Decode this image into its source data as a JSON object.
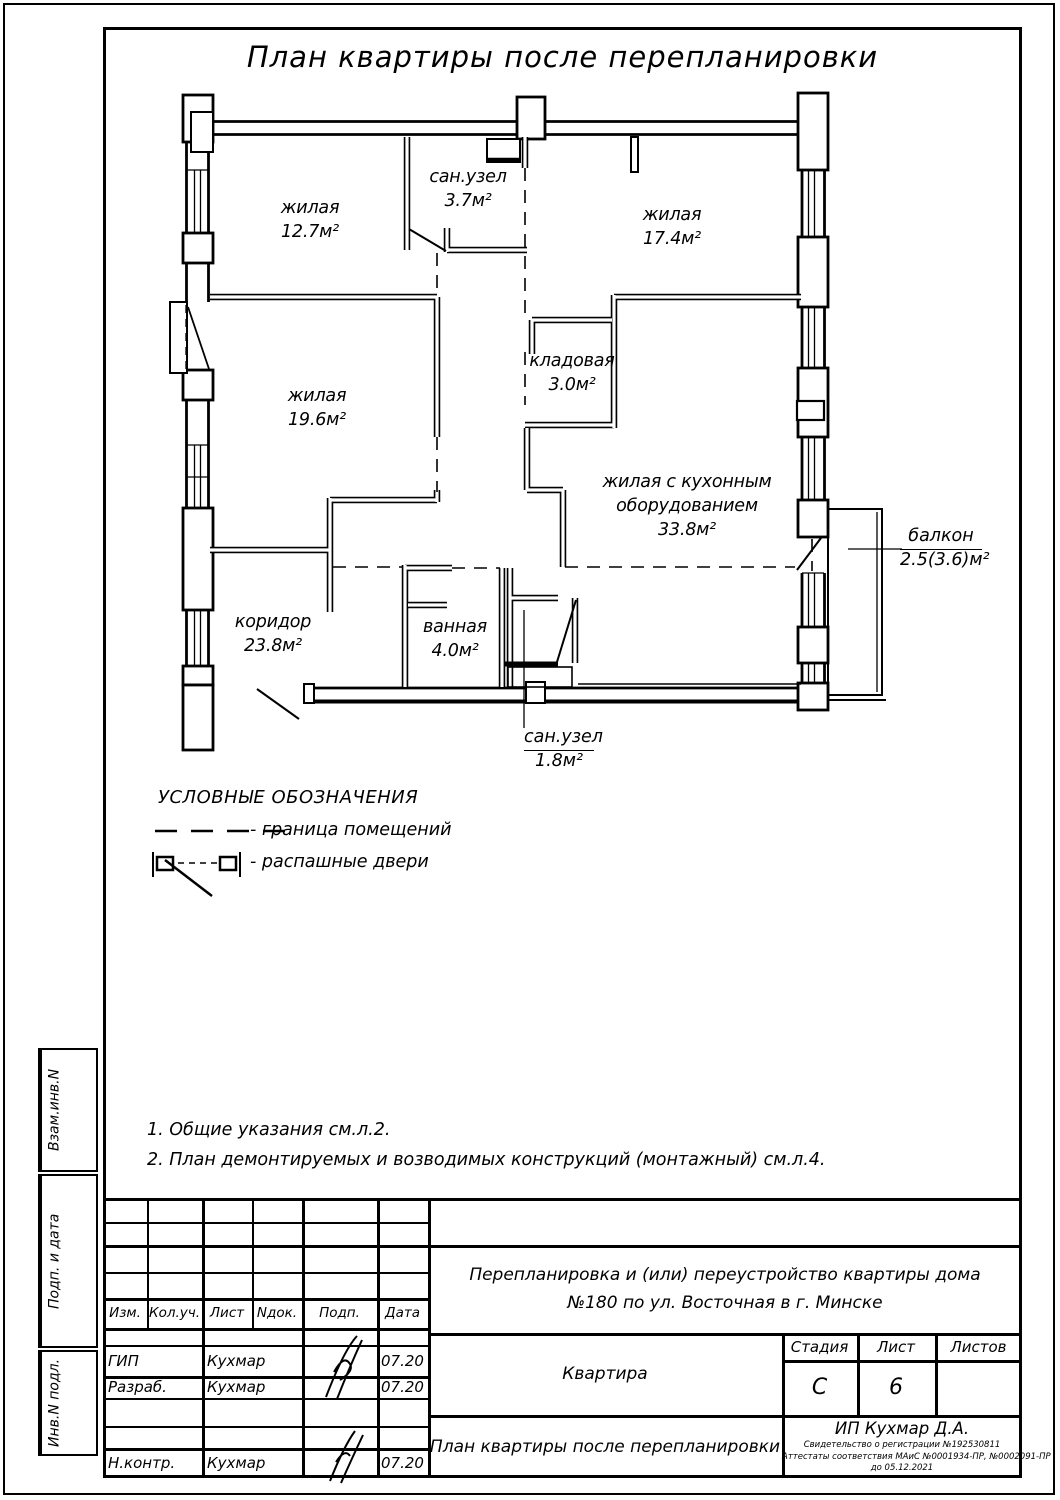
{
  "page_title": "План квартиры после перепланировки",
  "plan": {
    "rooms": [
      {
        "name1": "жилая",
        "area": "12.7м²"
      },
      {
        "name1": "сан.узел",
        "area": "3.7м²"
      },
      {
        "name1": "жилая",
        "area": "17.4м²"
      },
      {
        "name1": "жилая",
        "area": "19.6м²"
      },
      {
        "name1": "кладовая",
        "area": "3.0м²"
      },
      {
        "name1": "жилая с кухонным",
        "name2": "оборудованием",
        "area": "33.8м²"
      },
      {
        "name1": "коридор",
        "area": "23.8м²"
      },
      {
        "name1": "ванная",
        "area": "4.0м²"
      },
      {
        "name1": "сан.узел",
        "area": "1.8м²"
      },
      {
        "name1": "балкон",
        "area": "2.5(3.6)м²"
      }
    ]
  },
  "legend": {
    "title": "УСЛОВНЫЕ ОБОЗНАЧЕНИЯ",
    "items": [
      {
        "label": "- граница помещений"
      },
      {
        "label": "- распашные двери"
      }
    ]
  },
  "notes": [
    "1. Общие указания см.л.2.",
    "2. План демонтируемых и возводимых конструкций (монтажный) см.л.4."
  ],
  "sidebar": {
    "labels": [
      "Взам.инв.N",
      "Подп. и дата",
      "Инв.N подл."
    ]
  },
  "titleblock": {
    "columns": [
      "Изм.",
      "Кол.уч.",
      "Лист",
      "Nдок.",
      "Подп.",
      "Дата"
    ],
    "rows": [
      {
        "role": "ГИП",
        "name": "Кухмар",
        "date": "07.20"
      },
      {
        "role": "Разраб.",
        "name": "Кухмар",
        "date": "07.20"
      },
      {
        "role": "Н.контр.",
        "name": "Кухмар",
        "date": "07.20"
      }
    ],
    "project": "Перепланировка и (или) переустройство квартиры дома №180 по ул. Восточная в г. Минске",
    "object": "Квартира",
    "sheet_title": "План квартиры после перепланировки",
    "stage_label": "Стадия",
    "sheet_label": "Лист",
    "sheets_label": "Листов",
    "stage": "С",
    "sheet": "6",
    "sheets": "",
    "company": "ИП Кухмар Д.А.",
    "cert1": "Свидетельство о регистрации №192530811",
    "cert2": "Аттестаты соответствия МАиС №0001934-ПР, №0002091-ПР",
    "cert3": "до 05.12.2021"
  }
}
